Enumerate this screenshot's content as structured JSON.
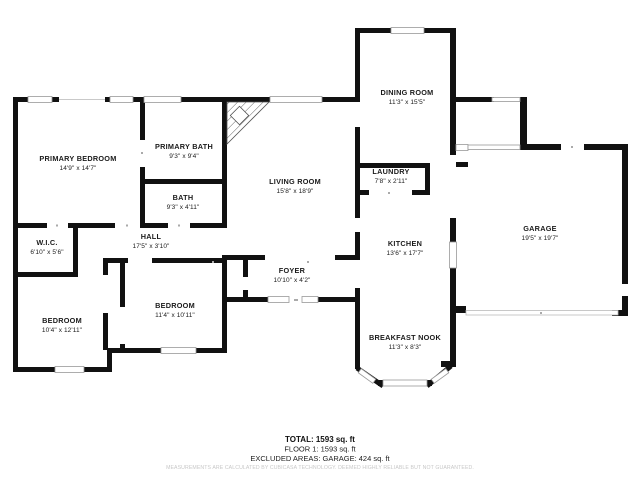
{
  "floor_plan": {
    "rooms": {
      "primary_bedroom": {
        "name": "PRIMARY BEDROOM",
        "dims": "14'9\" x 14'7\""
      },
      "primary_bath": {
        "name": "PRIMARY BATH",
        "dims": "9'3\" x 9'4\""
      },
      "bath": {
        "name": "BATH",
        "dims": "9'3\" x 4'11\""
      },
      "wic": {
        "name": "W.I.C.",
        "dims": "6'10\" x 5'6\""
      },
      "hall": {
        "name": "HALL",
        "dims": "17'5\" x 3'10\""
      },
      "bedroom_left": {
        "name": "BEDROOM",
        "dims": "10'4\" x 12'11\""
      },
      "bedroom_right": {
        "name": "BEDROOM",
        "dims": "11'4\" x 10'11\""
      },
      "living_room": {
        "name": "LIVING ROOM",
        "dims": "15'8\" x 18'9\""
      },
      "foyer": {
        "name": "FOYER",
        "dims": "10'10\" x 4'2\""
      },
      "dining_room": {
        "name": "DINING ROOM",
        "dims": "11'3\" x 15'5\""
      },
      "laundry": {
        "name": "LAUNDRY",
        "dims": "7'8\" x 2'11\""
      },
      "kitchen": {
        "name": "KITCHEN",
        "dims": "13'6\" x 17'7\""
      },
      "breakfast_nook": {
        "name": "BREAKFAST NOOK",
        "dims": "11'3\" x 8'3\""
      },
      "garage": {
        "name": "GARAGE",
        "dims": "19'5\" x 19'7\""
      }
    },
    "summary": {
      "total": "TOTAL: 1593 sq. ft",
      "floor1": "FLOOR 1: 1593 sq. ft",
      "excluded": "EXCLUDED AREAS: GARAGE: 424 sq. ft",
      "disclaimer": "MEASUREMENTS ARE CALCULATED BY CUBICASA TECHNOLOGY. DEEMED HIGHLY RELIABLE BUT NOT GUARANTEED."
    },
    "colors": {
      "wall": "#111111",
      "window_stroke": "#999999",
      "text": "#1b1b1b",
      "disclaimer": "#c8c8c8"
    }
  }
}
